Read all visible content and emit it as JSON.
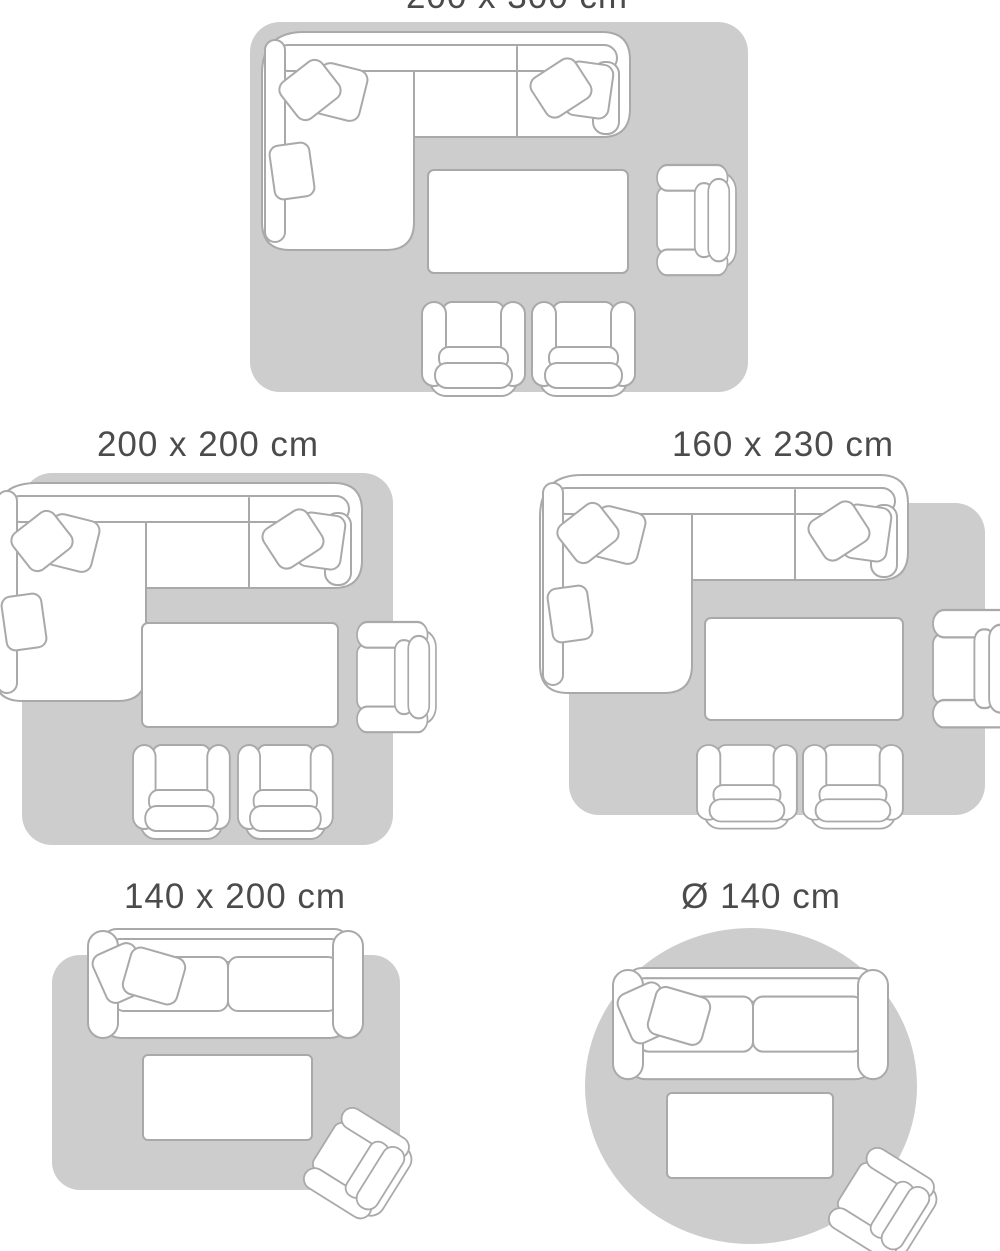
{
  "colors": {
    "rug": "#cdcdcd",
    "fill": "#ffffff",
    "stroke": "#a9a9a9",
    "text": "#4b4b4b"
  },
  "diagrams": [
    {
      "label": "200 x 300 cm",
      "rug_shape": "rectangle",
      "furniture": [
        "corner-sofa",
        "coffee-table",
        "armchair",
        "armchair",
        "armchair"
      ]
    },
    {
      "label": "200 x 200 cm",
      "rug_shape": "rectangle",
      "furniture": [
        "corner-sofa",
        "coffee-table",
        "armchair",
        "armchair",
        "armchair"
      ]
    },
    {
      "label": "160 x 230 cm",
      "rug_shape": "rectangle",
      "furniture": [
        "corner-sofa",
        "coffee-table",
        "armchair",
        "armchair",
        "armchair"
      ]
    },
    {
      "label": "140 x 200 cm",
      "rug_shape": "rectangle",
      "furniture": [
        "sofa",
        "coffee-table",
        "armchair"
      ]
    },
    {
      "label": "Ø 140 cm",
      "rug_shape": "circle",
      "furniture": [
        "sofa",
        "coffee-table",
        "armchair"
      ]
    }
  ]
}
